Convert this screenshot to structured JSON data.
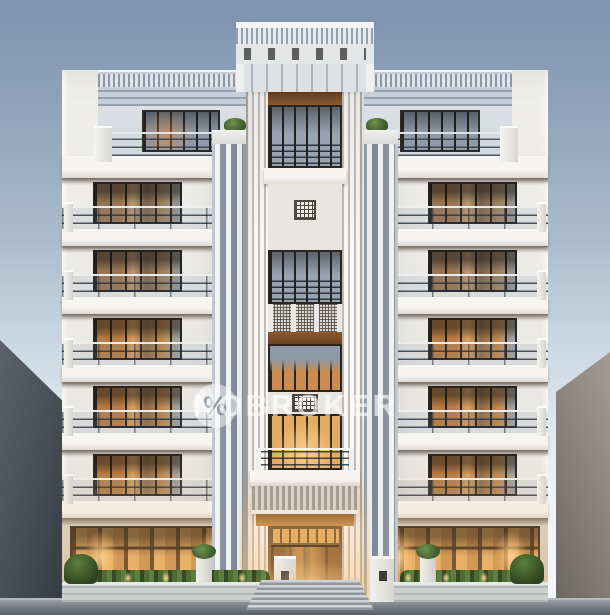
{
  "scene": {
    "subject": "White art-deco style apartment building exterior at dusk with lit windows, flanked by grey neighbouring buildings",
    "watermark": {
      "text": "NOBROKER",
      "logo_icon": "nobroker-percent-logo",
      "logo_glyph": "%",
      "color": "#FFFFFF",
      "opacity": 0.5
    },
    "building": {
      "wings": 2,
      "balcony_floors_per_wing": 5,
      "has_central_tower": true,
      "has_entrance_canopy": true
    }
  },
  "palette": {
    "sky_top": "#7E93B1",
    "sky_horizon": "#F0F4F6",
    "facade": "#ECEAE6",
    "slab": "#F4F3F0",
    "window_frame": "#2A241E",
    "warm_light": "#E0A25C",
    "cool_glass": "#9AA6B4",
    "railing": "#2A3442",
    "left_building": "#474C55",
    "right_building": "#8B847D",
    "pavement": "#74787F",
    "hedge_green": "#4C6B33",
    "wood_door": "#6E4424",
    "canopy": "#BDBAB4"
  }
}
